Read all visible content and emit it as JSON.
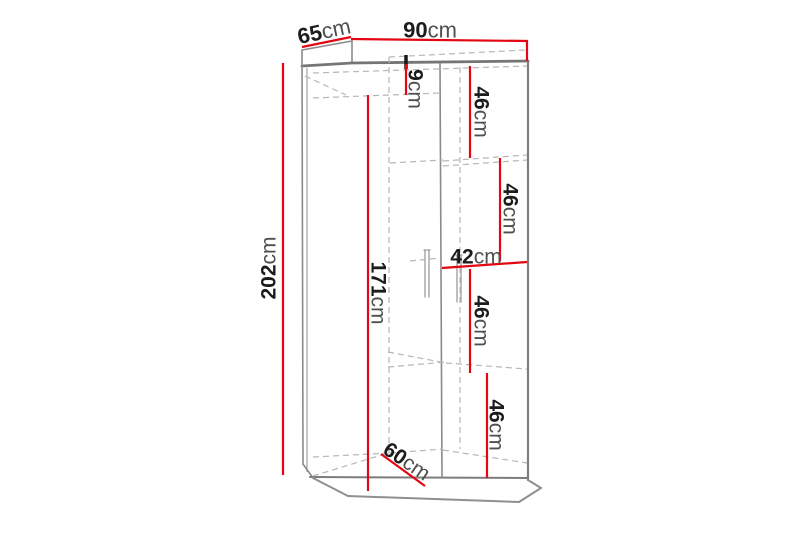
{
  "figure": {
    "figure_type": "furniture dimension diagram",
    "subject": "wardrobe with shelves, drawn in perspective with dashed interior lines",
    "colors": {
      "background": "#ffffff",
      "dimension_line_red": "#e30613",
      "outline_gray": "#8a8a8a",
      "dashed_interior_gray": "#b6b6b6",
      "number_text": "#1c1c1c",
      "unit_text": "#4f4f4f"
    },
    "dimensions": {
      "top_width": {
        "value": "90",
        "unit": "cm"
      },
      "top_depth": {
        "value": "65",
        "unit": "cm"
      },
      "total_height": {
        "value": "202",
        "unit": "cm"
      },
      "top_section_height": {
        "value": "9",
        "unit": "cm"
      },
      "left_interior_height": {
        "value": "171",
        "unit": "cm"
      },
      "right_section_width": {
        "value": "42",
        "unit": "cm"
      },
      "shelf_gap_1": {
        "value": "46",
        "unit": "cm"
      },
      "shelf_gap_2": {
        "value": "46",
        "unit": "cm"
      },
      "shelf_gap_3": {
        "value": "46",
        "unit": "cm"
      },
      "shelf_gap_4": {
        "value": "46",
        "unit": "cm"
      },
      "interior_depth": {
        "value": "60",
        "unit": "cm"
      }
    }
  }
}
